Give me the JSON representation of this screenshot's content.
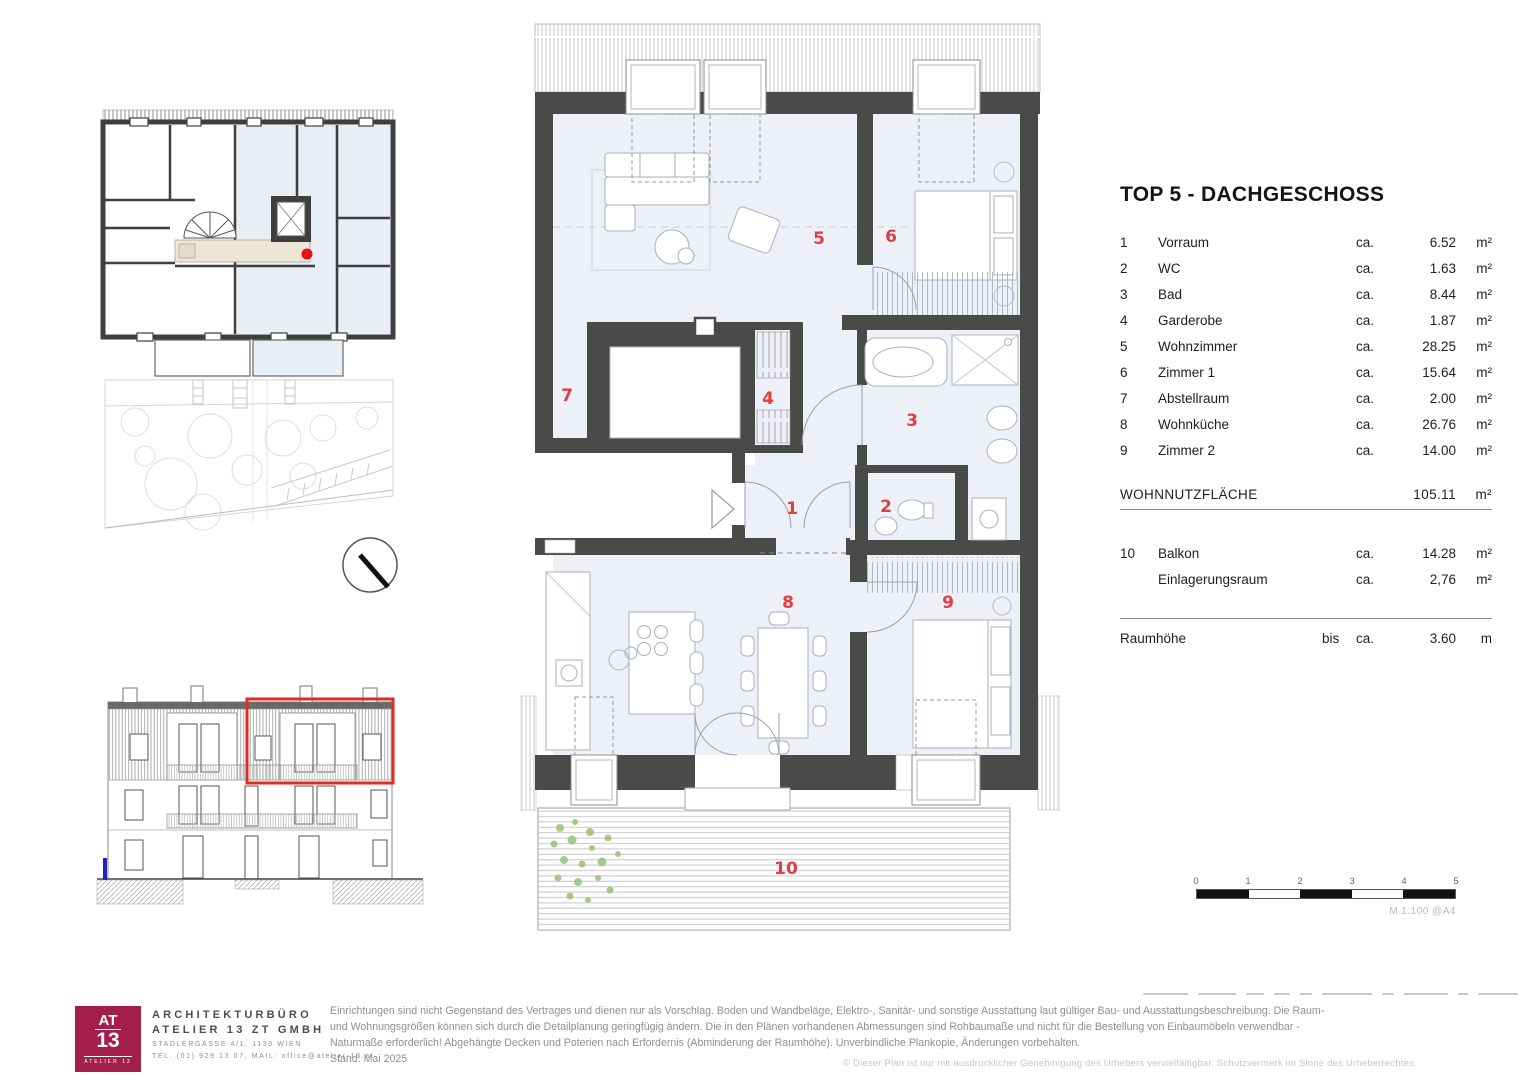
{
  "title": "TOP 5  - DACHGESCHOSS",
  "legend": {
    "rooms": [
      {
        "nr": "1",
        "name": "Vorraum",
        "ca": "ca.",
        "area": "6.52",
        "unit": "m²"
      },
      {
        "nr": "2",
        "name": "WC",
        "ca": "ca.",
        "area": "1.63",
        "unit": "m²"
      },
      {
        "nr": "3",
        "name": "Bad",
        "ca": "ca.",
        "area": "8.44",
        "unit": "m²"
      },
      {
        "nr": "4",
        "name": "Garderobe",
        "ca": "ca.",
        "area": "1.87",
        "unit": "m²"
      },
      {
        "nr": "5",
        "name": "Wohnzimmer",
        "ca": "ca.",
        "area": "28.25",
        "unit": "m²"
      },
      {
        "nr": "6",
        "name": "Zimmer 1",
        "ca": "ca.",
        "area": "15.64",
        "unit": "m²"
      },
      {
        "nr": "7",
        "name": "Abstellraum",
        "ca": "ca.",
        "area": "2.00",
        "unit": "m²"
      },
      {
        "nr": "8",
        "name": "Wohnküche",
        "ca": "ca.",
        "area": "26.76",
        "unit": "m²"
      },
      {
        "nr": "9",
        "name": "Zimmer 2",
        "ca": "ca.",
        "area": "14.00",
        "unit": "m²"
      }
    ],
    "total": {
      "label": "WOHNNUTZFLÄCHE",
      "value": "105.11",
      "unit": "m²"
    },
    "extras": [
      {
        "nr": "10",
        "name": "Balkon",
        "ca": "ca.",
        "area": "14.28",
        "unit": "m²"
      },
      {
        "nr": "",
        "name": "Einlagerungsraum",
        "ca": "ca.",
        "area": "2,76",
        "unit": "m²"
      }
    ],
    "height": {
      "label": "Raumhöhe",
      "prefix": "bis",
      "ca": "ca.",
      "value": "3.60",
      "unit": "m"
    }
  },
  "plan": {
    "labels": {
      "r1": "1",
      "r2": "2",
      "r3": "3",
      "r4": "4",
      "r5": "5",
      "r6": "6",
      "r7": "7",
      "r8": "8",
      "r9": "9",
      "r10": "10"
    }
  },
  "scalebar": {
    "t0": "0",
    "t1": "1",
    "t2": "2",
    "t3": "3",
    "t4": "4",
    "t5": "5",
    "caption": "M 1:100 @A4"
  },
  "footer": {
    "logo": {
      "top": "AT",
      "bottom": "13",
      "sub": "ATELIER 13"
    },
    "firm_line1": "ARCHITEKTURBÜRO",
    "firm_line2": "ATELIER 13 ZT GMBH",
    "firm_line3": "STADLERGASSE 4/1, 1130 WIEN",
    "firm_line4": "TEL. (01) 929 13 07, MAIL: office@atelier-13.at",
    "disclaimer": "Einrichtungen sind nicht Gegenstand des Vertrages und dienen nur als Vorschlag. Boden und Wandbeläge, Elektro-, Sanitär- und sonstige Ausstattung laut gültiger Bau- und Ausstattungsbeschreibung. Die Raum- und Wohnungsgrößen können sich durch die Detailplanung geringfügig ändern. Die in den Plänen vorhandenen Abmessungen sind Rohbaumaße und nicht für die Bestellung von Einbaumöbeln verwendbar - Naturmaße erforderlich! Abgehängte Decken und Poterien nach Erfordernis (Abminderung der Raumhöhe). Unverbindliche Plankopie, Änderungen vorbehalten.",
    "stand": "Stand: Mai 2025",
    "copyright": "© Dieser Plan ist nur mit ausdrücklicher Genehmigung des Urhebers vervielfältigbar. Schutzvermerk im Sinne des Urheberrechtes."
  },
  "colors": {
    "wall": "#4a4a48",
    "room_fill": "#edf0f6",
    "accent_red": "#e23c44",
    "highlight_red": "#e02a22",
    "logo_berry": "#a31e4b"
  }
}
